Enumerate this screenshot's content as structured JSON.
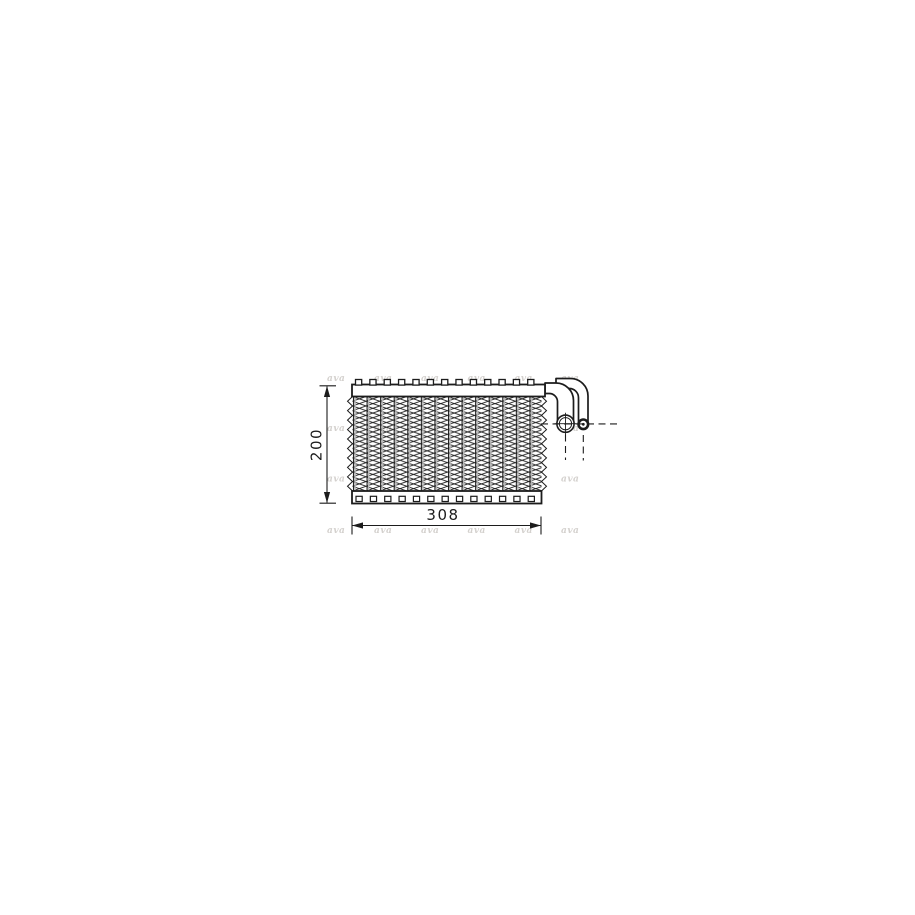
{
  "drawing": {
    "label": "Evaporator technical line drawing",
    "dimensions": {
      "height": "200",
      "width": "308"
    },
    "watermark": "ava",
    "colors": {
      "line": "#1c1c1c",
      "tube_shadow": "#b8b8b8",
      "watermark": "#d4d1ce",
      "background": "#ffffff"
    }
  }
}
